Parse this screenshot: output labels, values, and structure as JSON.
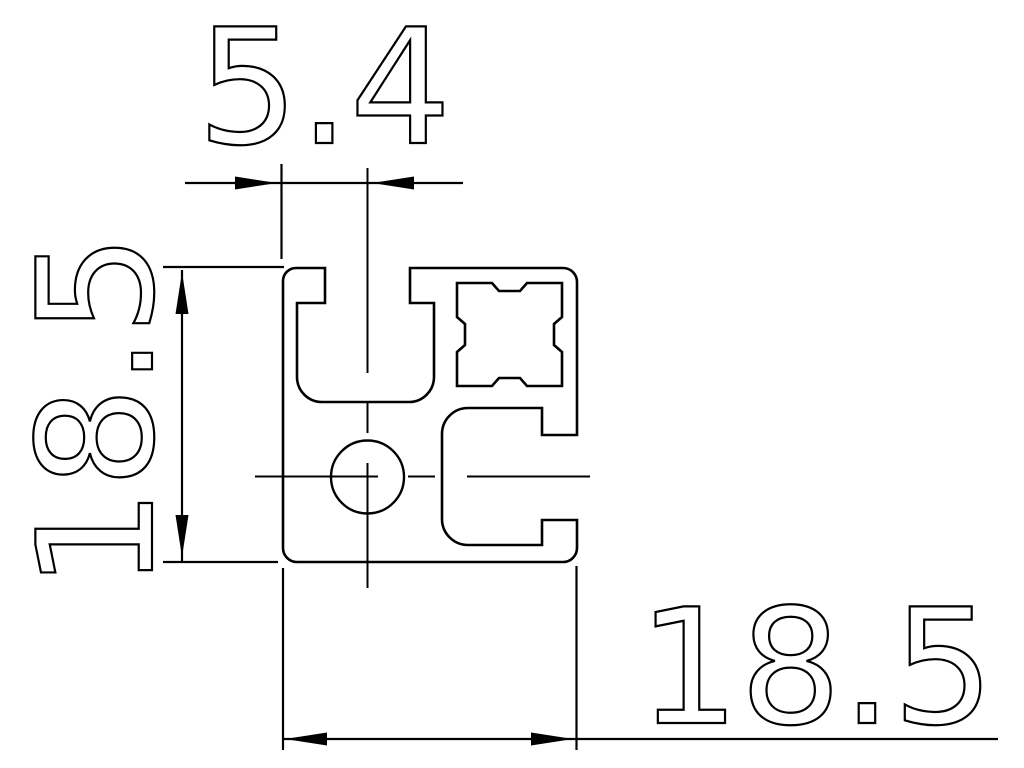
{
  "drawing": {
    "background_color": "#ffffff",
    "line_color": "#000000",
    "dimensions": {
      "top": "5.4",
      "left": "18.5",
      "bottom": "18.5"
    }
  }
}
